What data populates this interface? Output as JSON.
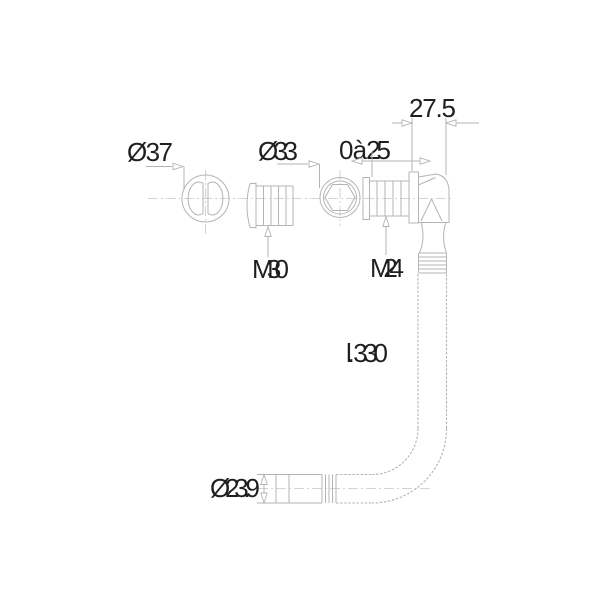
{
  "drawing": {
    "dimensions": {
      "cap_diameter": "Ø37",
      "nut_diameter": "Ø33",
      "adjustment_range": "0 à 25",
      "elbow_offset": "27.5",
      "thread_m30": "M30",
      "thread_m24": "M24",
      "hose_length": "l. 330",
      "outlet_diameter": "Ø23.9"
    },
    "colors": {
      "line": "#b4b4b4",
      "centerline": "#c6c6c6",
      "text": "#1f1f1f",
      "background": "#ffffff"
    }
  }
}
